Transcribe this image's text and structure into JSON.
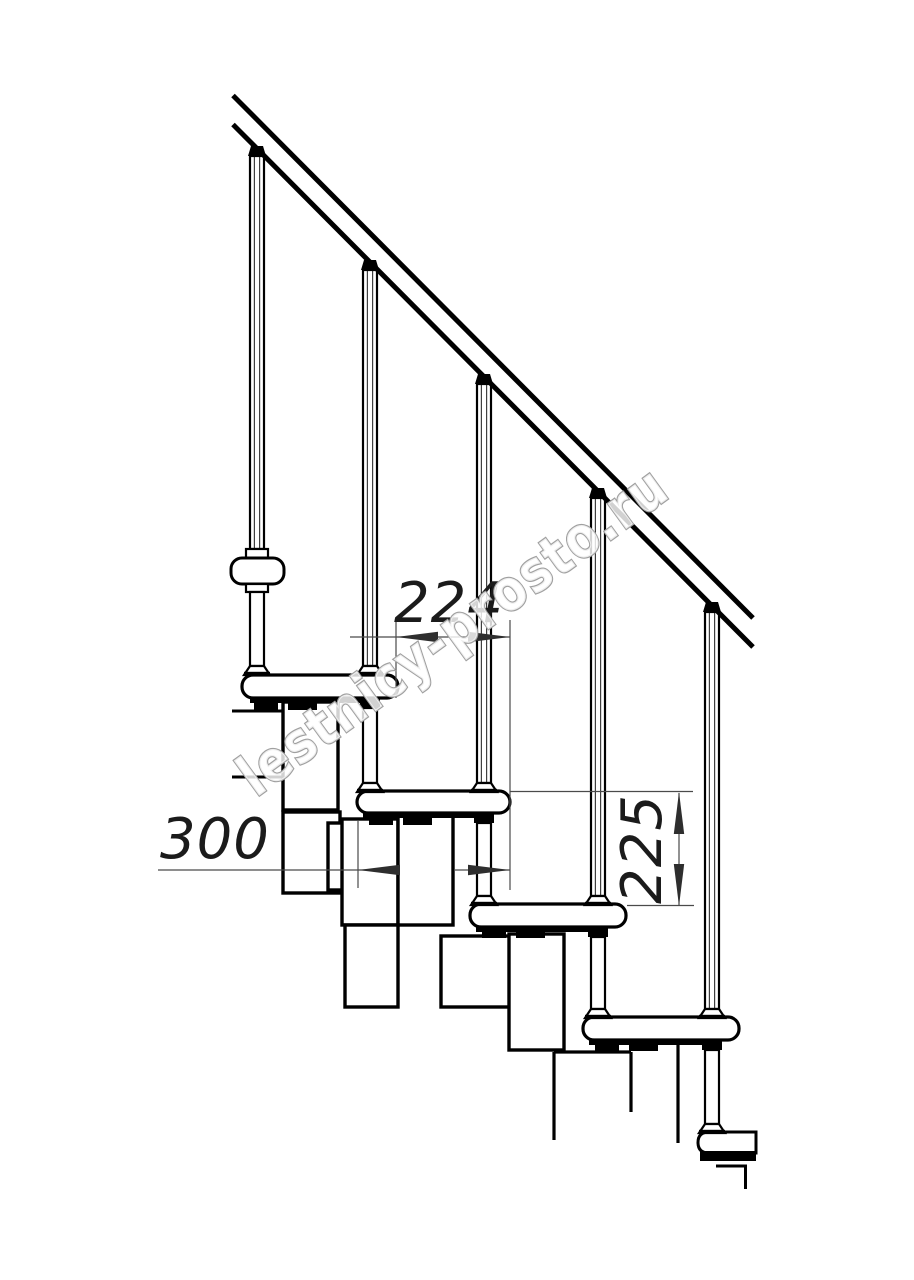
{
  "title": "Modular staircase side-view technical drawing",
  "watermark": {
    "text": "lestnicy-prosto.ru",
    "outline_color": "#a0a0a0"
  },
  "dimensions": {
    "going": {
      "label": "224",
      "value_mm": 224,
      "measures": "horizontal step pitch between tread edges"
    },
    "depth": {
      "label": "300",
      "value_mm": 300,
      "measures": "tread depth"
    },
    "rise": {
      "label": "225",
      "value_mm": 225,
      "measures": "vertical rise between treads"
    }
  },
  "drawing": {
    "background": "#ffffff",
    "line_color": "#000000",
    "dimension_line_color": "#4a4a4a",
    "label_color": "#1b1b1b",
    "treads_visible": 5,
    "balusters_visible": 5
  }
}
